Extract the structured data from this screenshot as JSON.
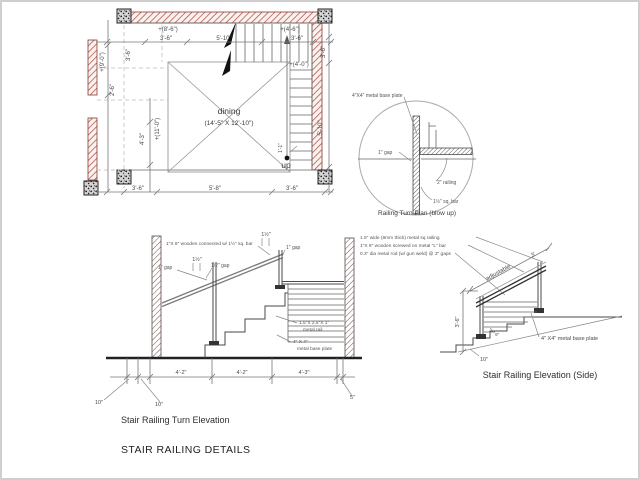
{
  "title": "STAIR RAILING DETAILS",
  "plan": {
    "room": "dining",
    "room_size": "(14'-5\" X 12'-10\")",
    "up": "up",
    "dims": {
      "top_offset_left": "+(8'-6\")",
      "top_left": "3'-6\"",
      "top_center": "5'-10\"",
      "top_offset_right": "+(4'-6\")",
      "top_right": "3'-6\"",
      "right_offset": "+(4'-0\")",
      "left_offset_upper": "+(9'-0\")",
      "left_upper": "3'-6\"",
      "left_mid": "2'-6\"",
      "left_lower": "4'-3\"",
      "left_offset_lower": "+(11'-0\")",
      "right_upper": "3'-6\"",
      "right_lower": "5'-10\"",
      "stair_width": "1'-1\"",
      "bottom_left": "3'-6\"",
      "bottom_center": "5'-8\"",
      "bottom_right": "3'-6\""
    }
  },
  "turn_plan": {
    "caption": "Railing Turn Plan (blow up)",
    "notes": {
      "base_plate": "4\"X4\" metal base plate",
      "gap": "1\" gap",
      "railing": "2\" railing",
      "sq_bar": "1½\" sq. bar"
    }
  },
  "turn_elevation": {
    "caption": "Stair Railing Turn Elevation",
    "notes": {
      "wooden": "1\"X 8\" wooden connected w/ 1½\" sq. bar",
      "rail_l1": "1.5\"X 2.5\"X 1\"",
      "rail_l2": "metal rail",
      "plate_l1": "4\" X 4\"",
      "plate_l2": "metal base plate",
      "dim_a": "1½\"",
      "gap_a": "1\" gap",
      "dim_b": "1½\"",
      "gap_b": "1\" gap",
      "gap_half": "1/2\" gap"
    },
    "dims": {
      "seg1": "4'-2\"",
      "seg2": "4'-2\"",
      "seg3": "4'-3\"",
      "ten1": "10\"",
      "ten2": "10\"",
      "five": "5\""
    }
  },
  "side_elevation": {
    "caption": "Stair Railing Elevation (Side)",
    "notes": {
      "line1": "1.5\" wide (8mm thick) metal sq railing",
      "line2": "1\"X 8\" wooden screwed on metal \"L\" bar",
      "line3": "0.3\" dia metal rod (w/ gun weld) @ 3\" gaps",
      "adjustable": "adjustable",
      "base_plate": "4\" X4\" metal base plate"
    },
    "dims": {
      "rail_len": "3'",
      "height": "3'-6\"",
      "tread": "10\"",
      "riser": "9\""
    }
  }
}
